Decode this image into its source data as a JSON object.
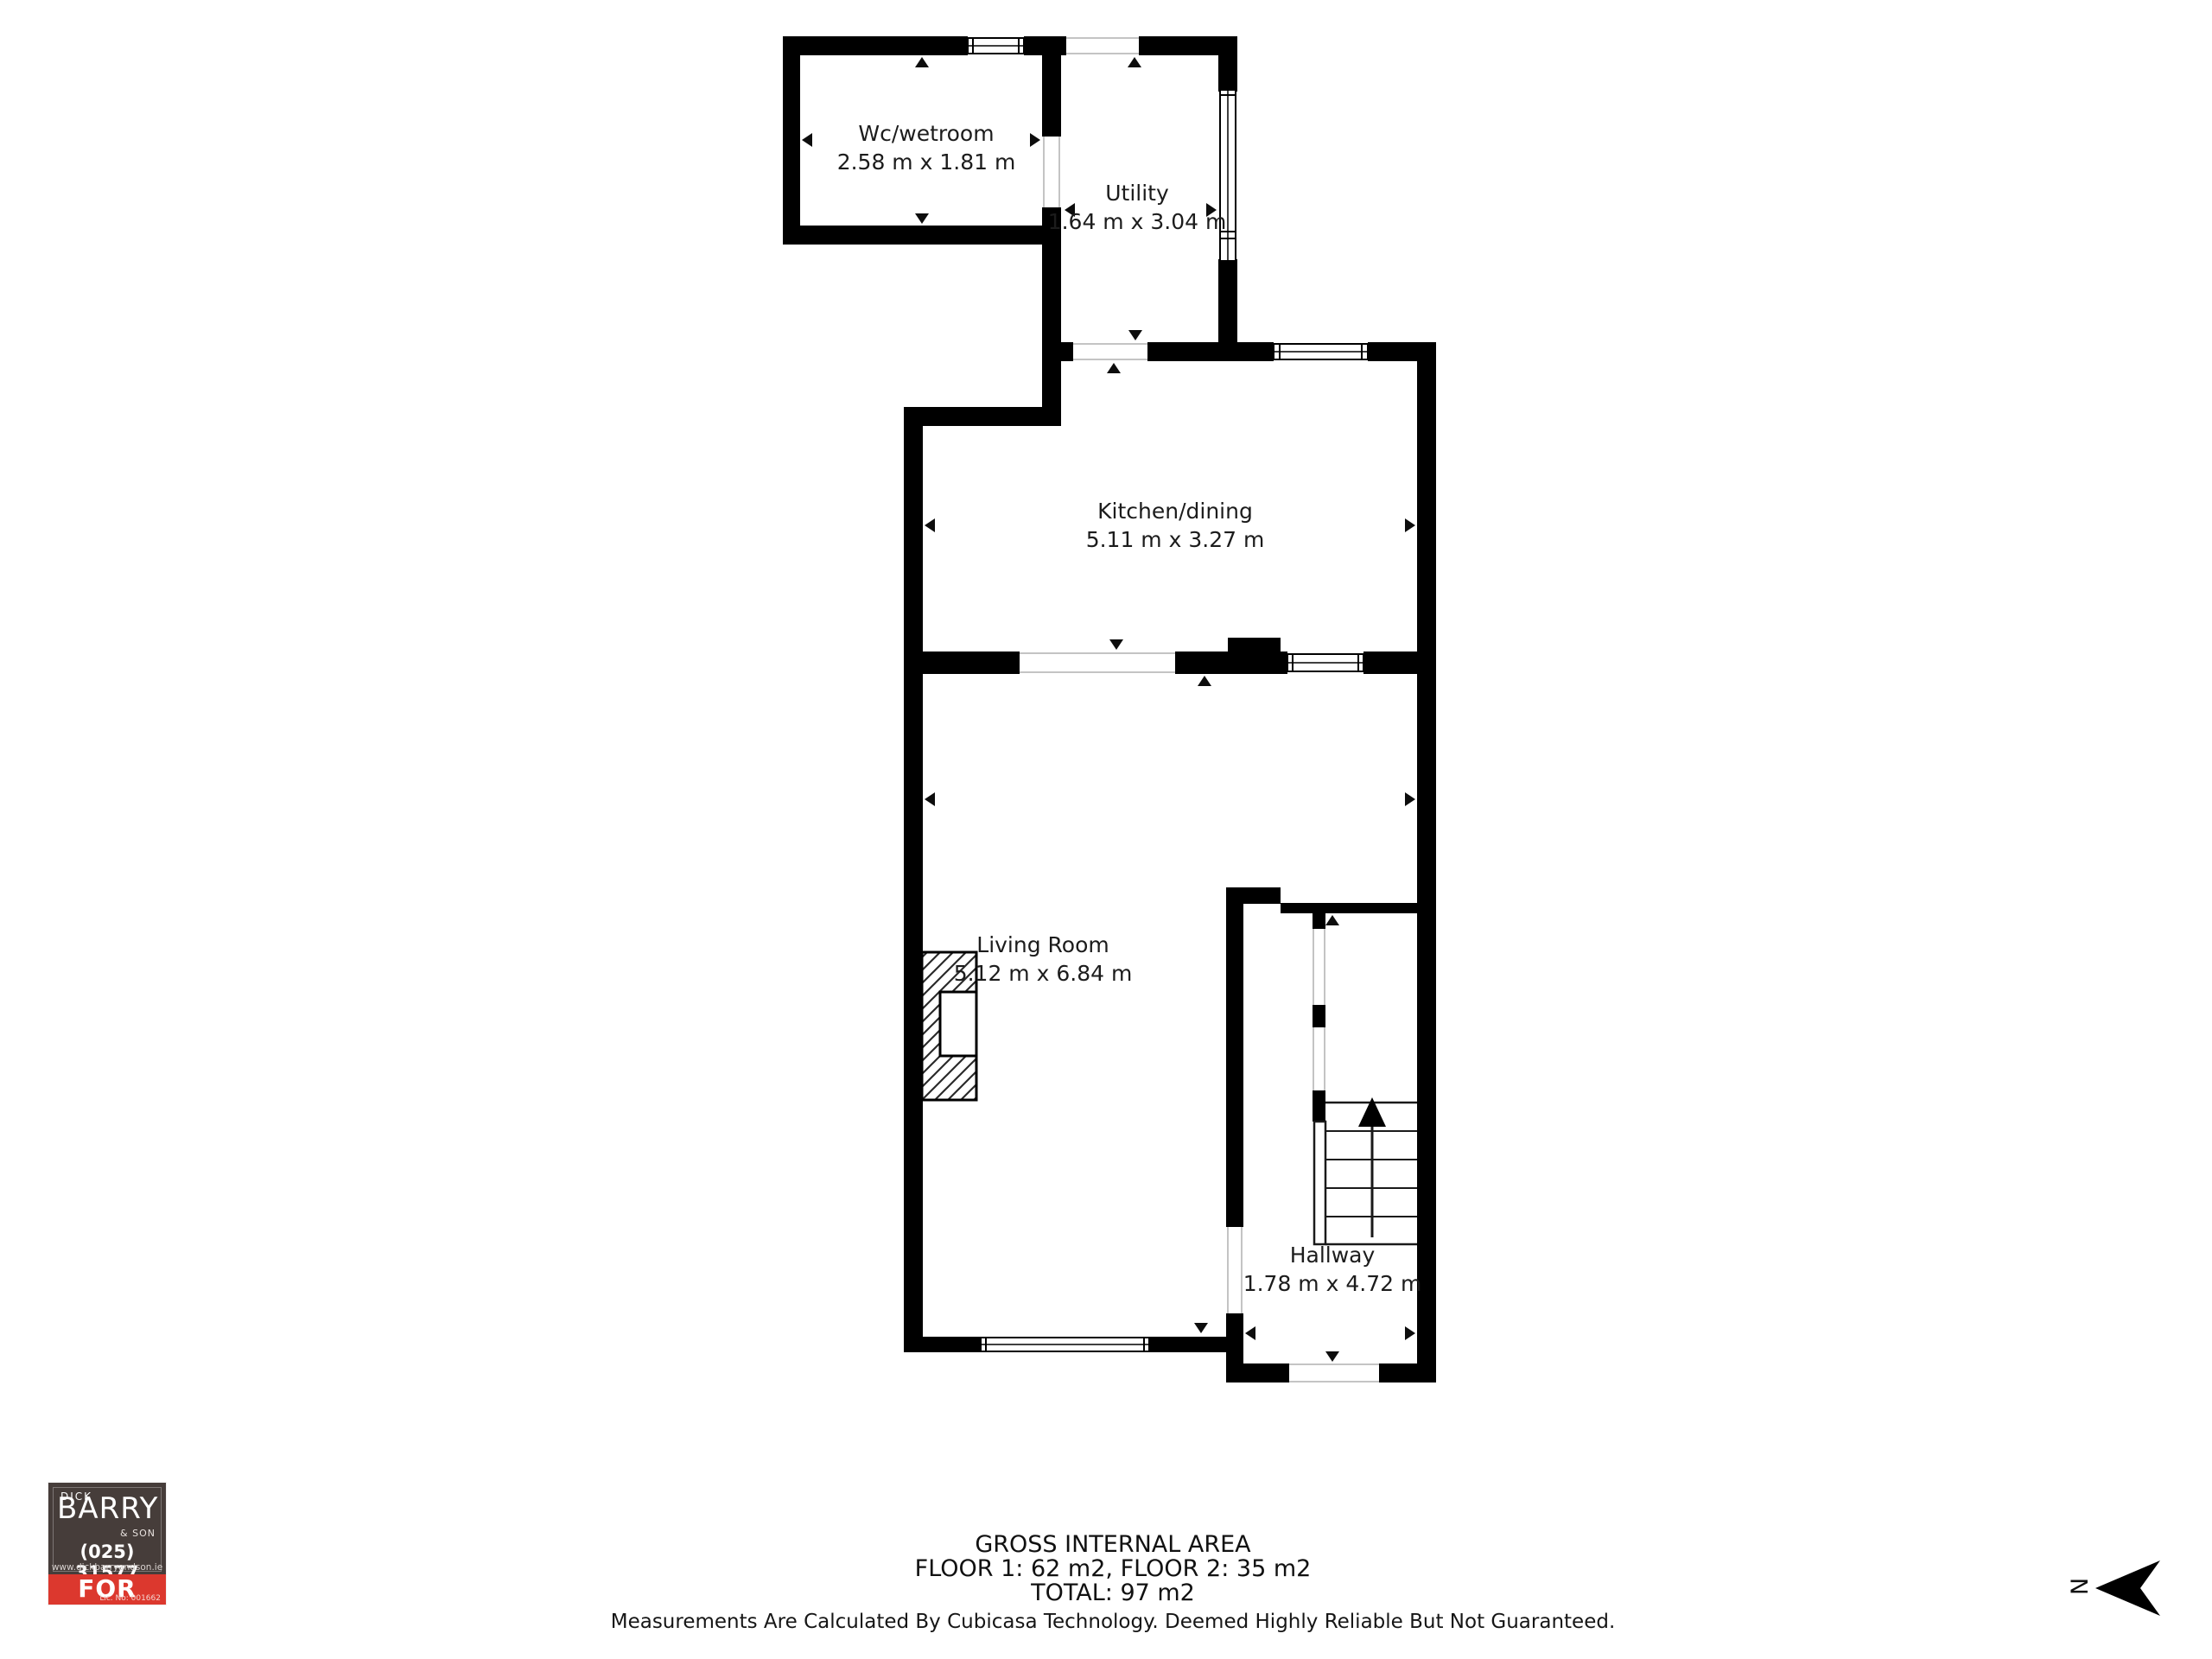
{
  "rooms": [
    {
      "id": "wc",
      "name": "Wc/wetroom",
      "dims": "2.58 m x 1.81 m"
    },
    {
      "id": "utility",
      "name": "Utility",
      "dims": "1.64 m x 3.04 m"
    },
    {
      "id": "kitchen",
      "name": "Kitchen/dining",
      "dims": "5.11 m x 3.27 m"
    },
    {
      "id": "living",
      "name": "Living Room",
      "dims": "5.12 m x 6.84 m"
    },
    {
      "id": "hallway",
      "name": "Hallway",
      "dims": "1.78 m x 4.72 m"
    }
  ],
  "footer": {
    "line1": "GROSS INTERNAL AREA",
    "line2": "FLOOR 1: 62 m2, FLOOR 2: 35 m2",
    "line3": "TOTAL: 97 m2",
    "disclaimer": "Measurements Are Calculated By Cubicasa Technology. Deemed Highly Reliable But Not Guaranteed."
  },
  "logo": {
    "top_name": "DICK",
    "name": "BARRY",
    "suffix": "& SON",
    "phone": "(025) 31577",
    "website": "www.dickbarryandson.ie",
    "banner": "FOR SALE",
    "license": "Lic. No: 001662",
    "colors": {
      "dark": "#463D3A",
      "red": "#DC382E",
      "wall": "#000000",
      "background": "#FFFFFF"
    }
  },
  "compass": {
    "label": "N"
  }
}
